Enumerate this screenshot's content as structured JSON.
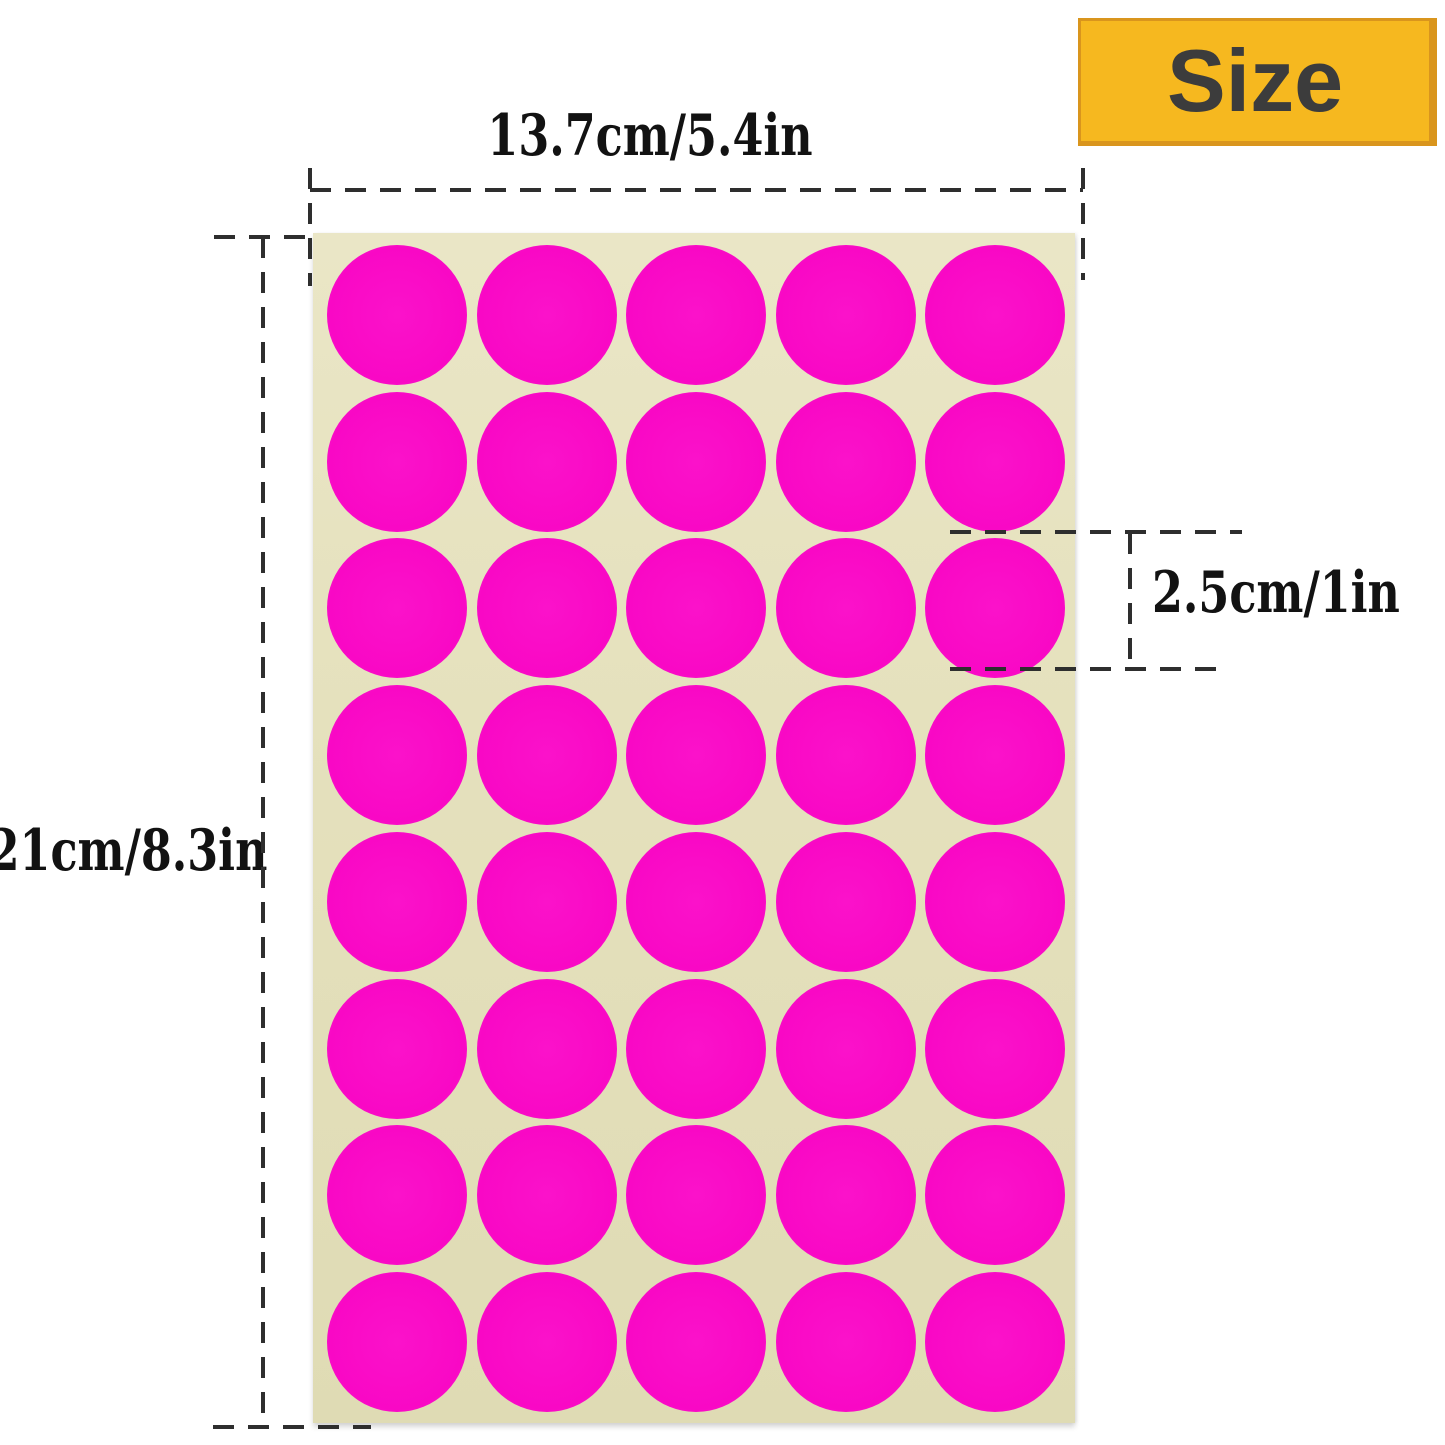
{
  "badge": {
    "label": "Size"
  },
  "dimensions": {
    "width_label": "13.7cm/5.4in",
    "height_label": "21cm/8.3in",
    "dot_label": "2.5cm/1in"
  },
  "sheet": {
    "rows": 8,
    "cols": 5,
    "dot_count": 40
  },
  "colors": {
    "background": "#FFFFFF",
    "badge_bg": "#F6B81F",
    "badge_border": "#D9951D",
    "badge_text": "#3C3C3C",
    "dash_line": "#2E2E2E",
    "label_text": "#121212",
    "sheet": "#E5E1BD",
    "dot": "#F908C5",
    "dot_rim": "#F9A8E1"
  }
}
